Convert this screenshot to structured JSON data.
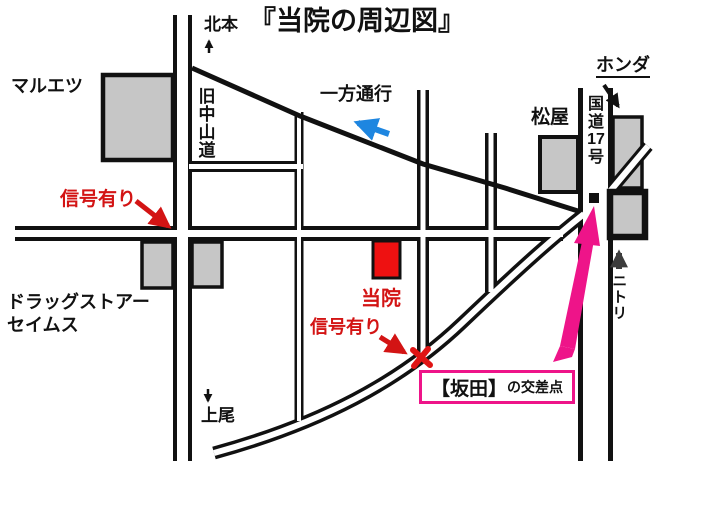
{
  "title": "『当院の周辺図』",
  "directions": {
    "north": "北本",
    "south": "上尾",
    "nitori": "ニトリ"
  },
  "places": {
    "maruetsu": "マルエツ",
    "kyu_nakasendo": "旧中山道",
    "one_way": "一方通行",
    "honda": "ホンダ",
    "matsuya": "松屋",
    "route17": {
      "p1": "国",
      "p2": "道",
      "p3": "17",
      "p4": "号"
    },
    "clinic": "当院",
    "drugstore_line1": "ドラッグストアー",
    "drugstore_line2": "セイムス"
  },
  "annotations": {
    "signal_left": "信号有り",
    "signal_center": "信号有り",
    "sakata_bracket": "【坂田】",
    "sakata_rest": "の交差点"
  },
  "colors": {
    "line_black": "#111111",
    "building_gray": "#c6c6c6",
    "clinic_red": "#ee1111",
    "annotation_red": "#d31414",
    "pink": "#ee1489",
    "one_way_blue": "#1e86e0"
  }
}
